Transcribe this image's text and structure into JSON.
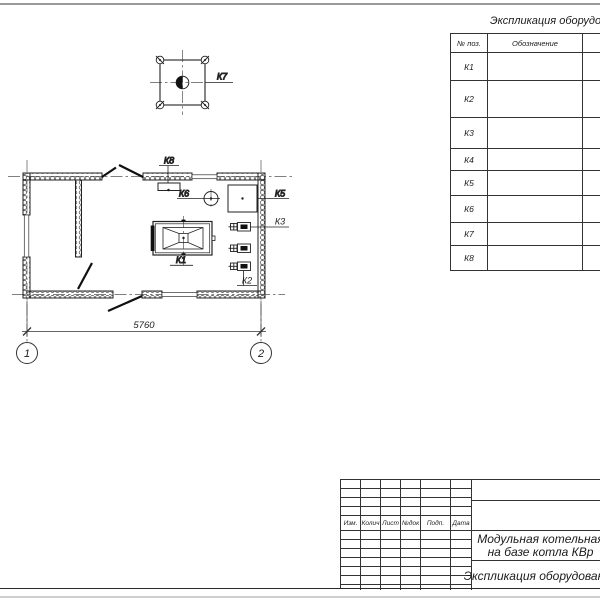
{
  "plan": {
    "labels": {
      "k1": "К1",
      "k2": "К2",
      "k3": "К3",
      "k5": "К5",
      "k6": "К6",
      "k7": "К7",
      "k8": "К8"
    },
    "dimension_width": "5760",
    "axes": {
      "a1": "1",
      "a2": "2"
    }
  },
  "spec_table": {
    "title": "Экспликация оборудования",
    "headers": {
      "pos": "№ поз.",
      "designation": "Обозначение"
    },
    "rows": [
      {
        "pos": "К1",
        "name_fragment": "Стал"
      },
      {
        "pos": "К2",
        "name_fragment": "На"
      },
      {
        "pos": "К3",
        "name_fragment": "Насос"
      },
      {
        "pos": "К4",
        "name_fragment": "Гр"
      },
      {
        "pos": "К5",
        "name_fragment": ""
      },
      {
        "pos": "К6",
        "name_fragment": "В"
      },
      {
        "pos": "К7",
        "name_fragment": ""
      },
      {
        "pos": "К8",
        "name_fragment": ""
      }
    ]
  },
  "title_block": {
    "revision_headers": [
      "Изм.",
      "Колич",
      "Лист",
      "№док",
      "Подп.",
      "Дата"
    ],
    "project_line1": "Модульная котельная",
    "project_line2": "на базе котла КВр",
    "sheet_name": "Экспликация оборудования"
  }
}
